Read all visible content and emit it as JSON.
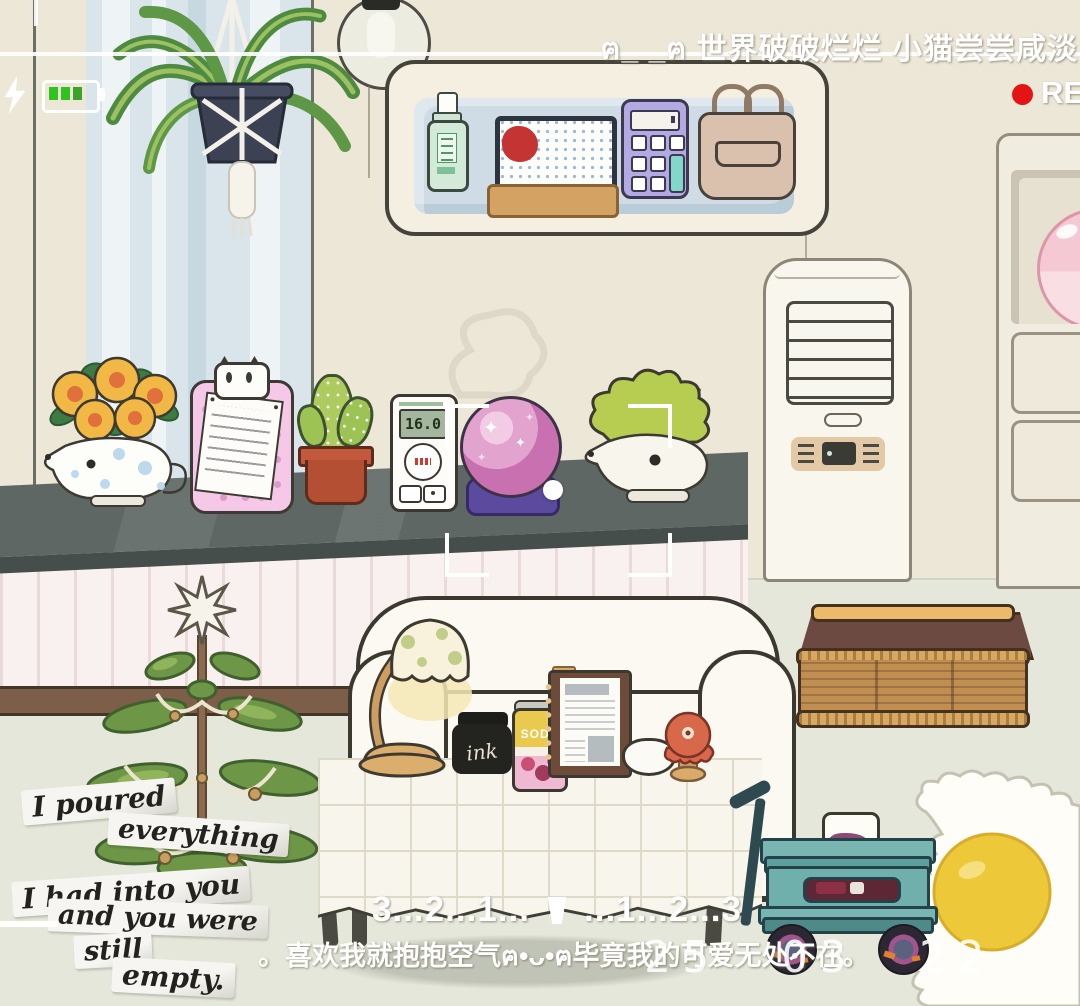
{
  "hud": {
    "status_text": "ฅ_ _ฅ 世界破破烂烂 小猫尝尝咸淡",
    "rec_label": "RE",
    "battery_level": "3-bars",
    "countdown_left": "3...2...1...",
    "countdown_right": "...1...2...3",
    "caption": "。喜欢我就抱抱空气ฅ•ᴗ•ฅ毕竟我的可爱无处不在。",
    "date_stamp": "25 03 22"
  },
  "notes": {
    "lines": [
      "I poured",
      "everything",
      "I had into you",
      "and you were",
      "still",
      "empty."
    ]
  },
  "items": {
    "thermostat_reading": "16.0",
    "ink_label": "ink",
    "soda_label": "SODA",
    "sparkle": "✦"
  },
  "colors": {
    "battery_green": "#2fc41d",
    "rec_red": "#e51414",
    "wall_cream": "#ece7d7",
    "floor_green": "#e4e7d9",
    "window_blue": "#d9e5ea",
    "counter_gray": "#5e6764",
    "wagon_teal": "#6fb0ad",
    "rug_yolk": "#edc93a",
    "crystal_pink": "#d884c0"
  }
}
